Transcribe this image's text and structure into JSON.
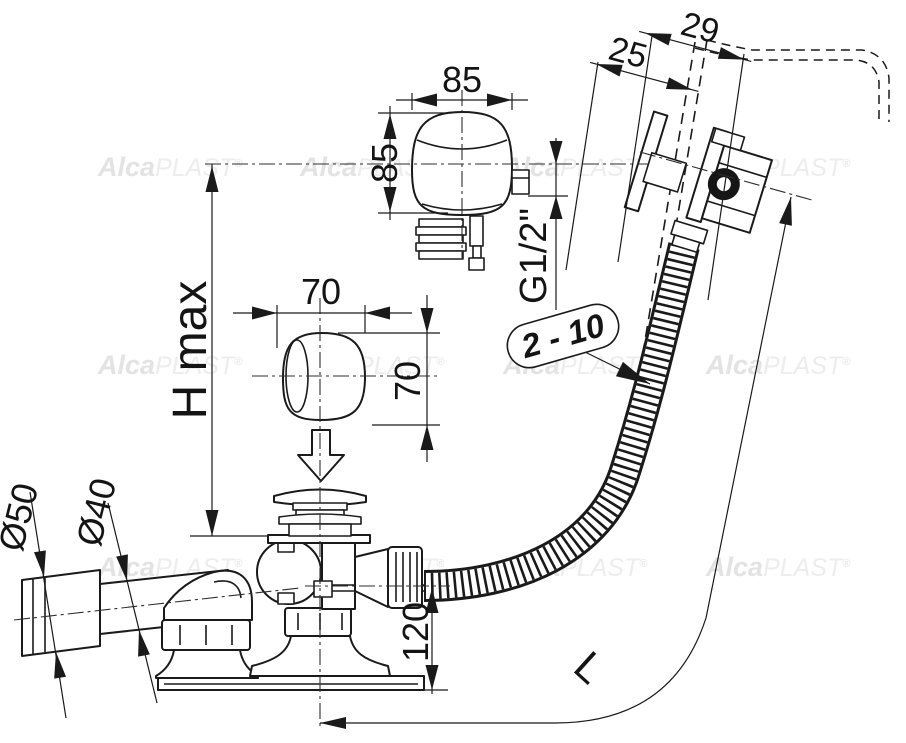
{
  "drawing": {
    "dimensions": {
      "overflow_width": "85",
      "overflow_height": "85",
      "thread_size": "G1/2\"",
      "knob_width": "70",
      "knob_height": "70",
      "height_max": "H max",
      "rim_total": "29",
      "rim_inner": "25",
      "wall_range": "2 - 10",
      "outlet_dia": "Ø50",
      "pipe_dia": "Ø40",
      "waste_height": "120",
      "hose_length": "L"
    },
    "watermark": {
      "bold": "Alca",
      "light": "PLAST",
      "reg": "®"
    }
  }
}
